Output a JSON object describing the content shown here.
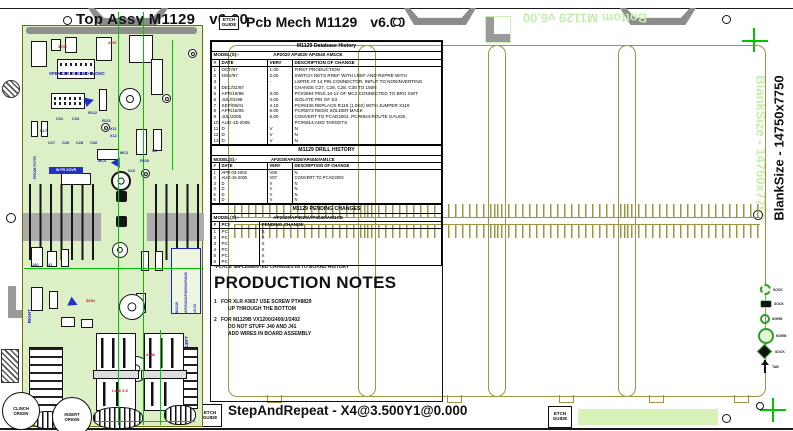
{
  "titles": {
    "top_assy": "Top Assy M1129",
    "top_assy_ver": "v6.00",
    "pcb_mech": "Pcb Mech M1129",
    "pcb_mech_ver": "v6.00",
    "bottom_mirrored": "Bottom M1129 v6.00",
    "blank_size": "BlankSize - 14750x7750",
    "step_and_repeat": "StepAndRepeat - X4@3.500Y1@0.000",
    "etch_line1": "ETCH",
    "etch_line2": "GUIDE"
  },
  "db_history": {
    "title": "M1129 Database History",
    "model_label": "MODEL(S):-",
    "models": "AP2020  AP4020  AP4040  AM1CE",
    "headers": [
      "#",
      "DATE",
      "VER#",
      "DESCRIPTION OF CHANGE"
    ],
    "rows": [
      [
        "1",
        "OCT/97",
        "1.00",
        "FIRST PRODUCTION"
      ],
      [
        "2",
        "NOV/97",
        "2.00",
        "SWITCH NETS RREF WITH LREF AND RSPRE WITH"
      ],
      [
        "3",
        "",
        "-",
        "LSPRE AT 14 PIN CONNECTOR. INPUT TO NONINVERTING"
      ],
      [
        "4",
        "DEC/02/97",
        "",
        "CHANGE C27, C29, C28, C30 TO 150N"
      ],
      [
        "5",
        "APR/16/98",
        "3.00",
        "PC#3694 PINS 10-12 OF MC2 CONNECTED TO BRG SWT"
      ],
      [
        "6",
        "JUL/01/98",
        "4.00",
        "ISOLATE PIN OF S3"
      ],
      [
        "7",
        "SEP/06/01",
        "4.10",
        "PC#6436 REPLACE R119 (1.0K0) WITH JUMPER X119"
      ],
      [
        "8",
        "APR/15/05",
        "5.00",
        "PC#6873 REDO SOLDER MASK"
      ],
      [
        "9",
        "JUL/2005",
        "6.00",
        "CONVERT TO PCAD2002, PC#6944:ROUTE GAUGE,"
      ],
      [
        "10",
        "AUG-15-2005",
        "",
        "PC#6914:ADD TARGETS"
      ],
      [
        "11",
        "D",
        "V",
        "N"
      ],
      [
        "12",
        "D",
        "V",
        "N"
      ],
      [
        "13",
        "D",
        "V",
        "N"
      ]
    ]
  },
  "drill_history": {
    "title": "M1129 DRILL HISTORY",
    "model_label": "MODEL(S):-",
    "models": "AP2020/AP4020/AP4040/AM1CE",
    "headers": [
      "#",
      "DATE",
      "VER#",
      "DESCRIPTION OF CHANGE"
    ],
    "rows": [
      [
        "1",
        "APR-03-2003",
        "V06",
        "N"
      ],
      [
        "2",
        "AUG-15-2005",
        "V07",
        "CONVERT TO PCAD2002"
      ],
      [
        "3",
        "D",
        "V",
        "N"
      ],
      [
        "4",
        "D",
        "V",
        "N"
      ],
      [
        "5",
        "D",
        "V",
        "N"
      ],
      [
        "6",
        "D",
        "V",
        "N"
      ]
    ]
  },
  "pending_changes": {
    "title": "M1129 PENDING CHANGES",
    "model_label": "MODEL(S):-",
    "models": "AP2020/AP4020/AP4040/AM1CE",
    "headers": [
      "#",
      "PC#",
      "PENDING CHANGE"
    ],
    "rows": [
      [
        "1",
        "PC",
        "X"
      ],
      [
        "2",
        "PC",
        "X"
      ],
      [
        "3",
        "PC",
        "X"
      ],
      [
        "4",
        "PC",
        "X"
      ],
      [
        "5",
        "PC",
        "X"
      ],
      [
        "6",
        "PC",
        "X"
      ]
    ]
  },
  "notes": {
    "place_note": "*PLACE IMPLEMENTED CHANGES IN TO BOARD HISTORY",
    "title": "PRODUCTION NOTES",
    "note1_num": "1",
    "note1_l1": "FOR XLR #3657 USE SCREW PT#8829",
    "note1_l2": "UP THROUGH THE BOTTOM",
    "note2_num": "2",
    "note2_l1": "FOR M1129B VX1200/2400/J/2402",
    "note2_l2": "DO NOT STUFF J40 AND J41",
    "note2_l3": "ADD WIRES IN BOARD ASSEMBLY"
  },
  "pcb": {
    "side_right": "RIGHT",
    "side_left": "LEFT",
    "from_pots": "FROM POTS",
    "in_fr_xovr": "IN FR XOVR",
    "speaker": "SPEAKER -STEREO- MONO",
    "tb_model": "M1129",
    "tb_series": "AP2020/AP4020/AP4040",
    "tb_ver": "v6.00",
    "refdes": [
      "C31",
      "C34",
      "R112",
      "R111",
      "C27",
      "C29",
      "C28",
      "C30",
      "MC2",
      "MC3",
      "X11",
      "X12",
      "X13",
      "R119",
      "S3",
      "C17",
      "J40",
      "J41"
    ],
    "red_labels": [
      "3497",
      "3706",
      "3694",
      "2436",
      "LINE 2.5"
    ]
  },
  "origins": {
    "clinch_l1": "CLINCH",
    "clinch_l2": "ORIGIN",
    "insert_l1": "INSERT",
    "insert_l2": "ORIGIN"
  },
  "legend": {
    "items": [
      {
        "icon": "dashed-circle-pad",
        "label": "SOCK"
      },
      {
        "icon": "black-pad",
        "label": "SOCK"
      },
      {
        "icon": "ring-pad",
        "label": "NORM"
      },
      {
        "icon": "large-ring-pad",
        "label": "NORM"
      },
      {
        "icon": "diamond-pad",
        "label": "SOCK"
      },
      {
        "icon": "pin-tab",
        "label": "TAB"
      }
    ]
  },
  "colors": {
    "panel_olive": "#9d9444",
    "board_green": "#ddefc6",
    "trace_green": "#00c400",
    "silk_blue": "#1f1fbb",
    "silk_red": "#cc1133",
    "mirror_text_green": "#c8ecae"
  }
}
